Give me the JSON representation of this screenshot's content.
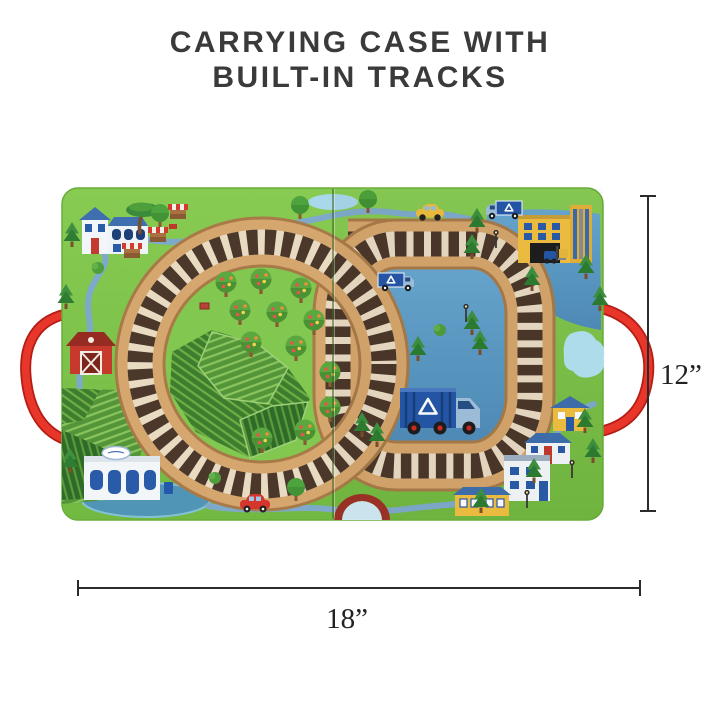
{
  "title": {
    "line1": "CARRYING CASE WITH",
    "line2": "BUILT-IN TRACKS"
  },
  "dimensions": {
    "height_label": "12”",
    "width_label": "18”"
  },
  "colors": {
    "background": "#ffffff",
    "board_green": "#7cc24b",
    "track_wood": "#d5a66d",
    "track_edge": "#a87a48",
    "tie_dark": "#4b382b",
    "tie_light": "#e9dbc2",
    "lake_blue": "#5c9bc6",
    "road_blue": "#7fa9cb",
    "handle_red": "#e03222",
    "barn_red": "#c7382d",
    "factory_yellow": "#f0c040",
    "truck_blue": "#2458a8",
    "title_text": "#3a3a3a",
    "dimension_ink": "#2b2b2b"
  },
  "scene_objects": [
    "carry-handle-rope",
    "train-track-loops",
    "farmhouse",
    "market-stalls",
    "red-barn",
    "farm-fields",
    "orchard-trees",
    "recycling-center",
    "pond",
    "lake",
    "recycling-trucks",
    "taxi-car",
    "red-car",
    "factory",
    "forklift",
    "street-lamps",
    "houses",
    "pine-trees",
    "arch-bridge"
  ]
}
